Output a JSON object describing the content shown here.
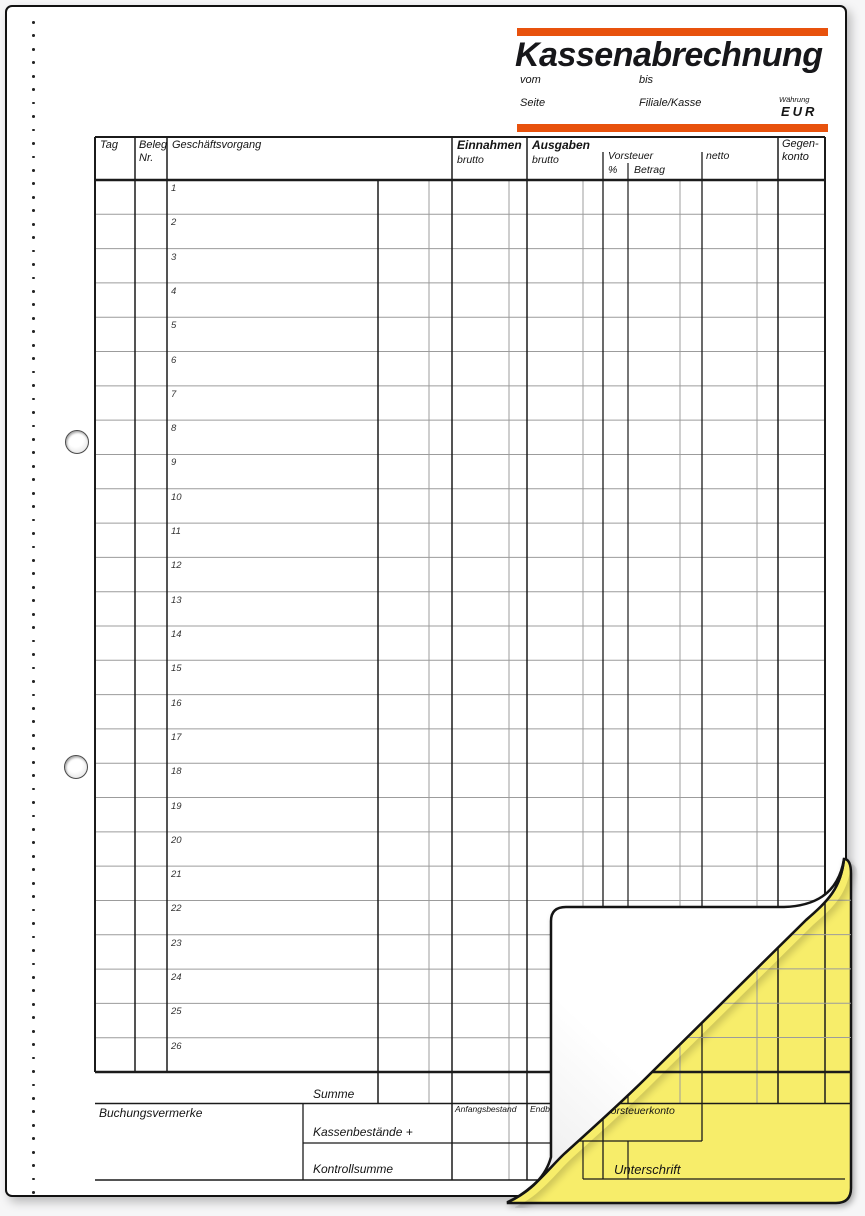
{
  "header": {
    "title": "Kassenabrechnung",
    "vom": "vom",
    "bis": "bis",
    "seite": "Seite",
    "filiale_kasse": "Filiale/Kasse",
    "waehrung_label": "Währung",
    "waehrung_value": "EUR"
  },
  "table": {
    "col_tag": "Tag",
    "col_beleg": "Beleg",
    "col_beleg_nr": "Nr.",
    "col_geschaeftsvorgang": "Geschäftsvorgang",
    "col_einnahmen": "Einnahmen",
    "col_einnahmen_sub": "brutto",
    "col_ausgaben": "Ausgaben",
    "col_ausgaben_sub": "brutto",
    "col_vorsteuer": "Vorsteuer",
    "col_vorsteuer_pct": "%",
    "col_vorsteuer_betrag": "Betrag",
    "col_netto": "netto",
    "col_gegenkonto_line1": "Gegen-",
    "col_gegenkonto_line2": "konto",
    "row_numbers": [
      1,
      2,
      3,
      4,
      5,
      6,
      7,
      8,
      9,
      10,
      11,
      12,
      13,
      14,
      15,
      16,
      17,
      18,
      19,
      20,
      21,
      22,
      23,
      24,
      25,
      26
    ]
  },
  "footer": {
    "summe": "Summe",
    "buchungsvermerke": "Buchungsvermerke",
    "kassenbestaende": "Kassenbestände +",
    "kontrollsumme": "Kontrollsumme",
    "anfangsbestand": "Anfangsbestand",
    "endbestand": "Endbestand",
    "vorsteuerkonto": "Vorsteuerkonto",
    "unterschrift": "Unterschrift"
  },
  "colors": {
    "accent_orange": "#E8520D",
    "copy_yellow": "#F7ED6A",
    "line_dark": "#1b1b1b",
    "line_gray": "#9c9c9c"
  }
}
